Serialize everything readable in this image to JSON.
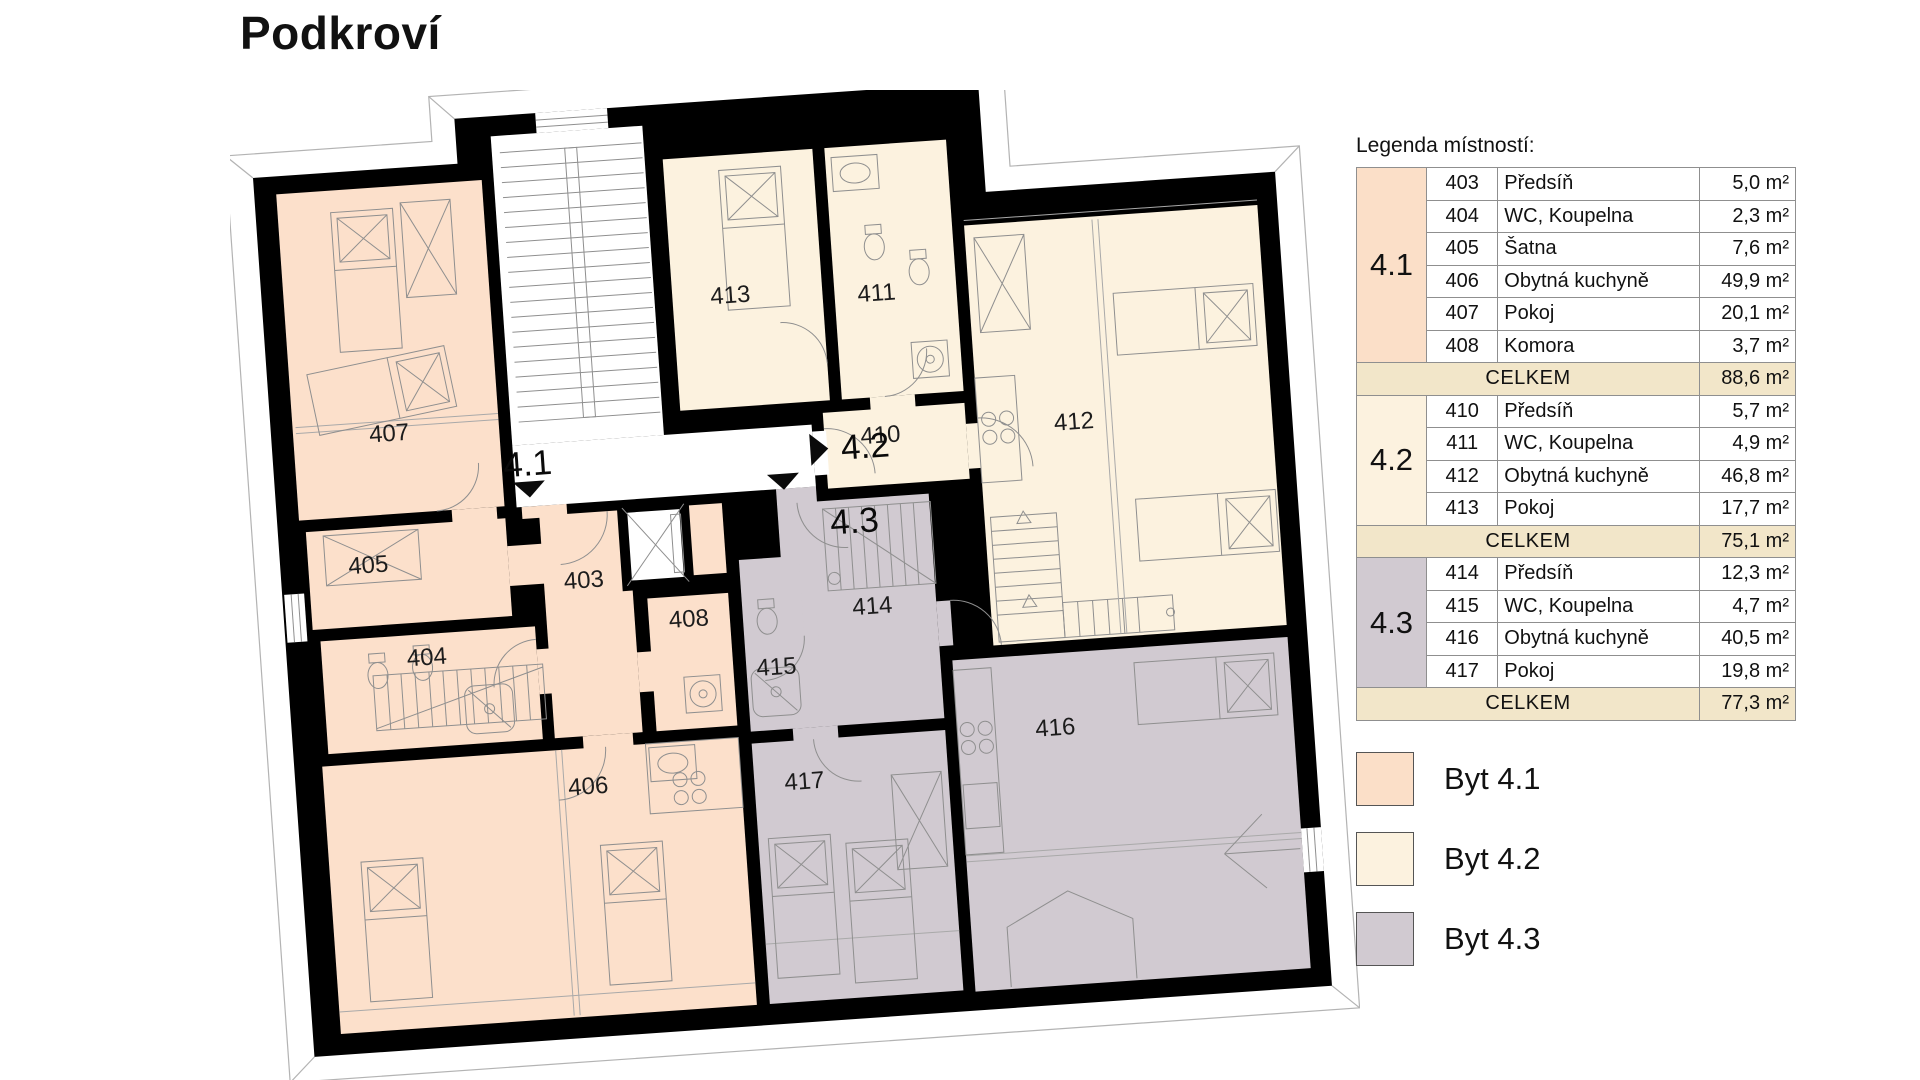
{
  "header": {
    "title": "Podkroví"
  },
  "plan": {
    "apartments": [
      {
        "id": "4.1",
        "label": "4.1",
        "color": "#fbdfc8",
        "entry_arrow": "down"
      },
      {
        "id": "4.2",
        "label": "4.2",
        "color": "#fcf2df",
        "entry_arrow": "right"
      },
      {
        "id": "4.3",
        "label": "4.3",
        "color": "#d1cad1",
        "entry_arrow": "down"
      }
    ],
    "rooms": {
      "403": {
        "label": "403"
      },
      "404": {
        "label": "404"
      },
      "405": {
        "label": "405"
      },
      "406": {
        "label": "406"
      },
      "407": {
        "label": "407"
      },
      "408": {
        "label": "408"
      },
      "410": {
        "label": "410"
      },
      "411": {
        "label": "411"
      },
      "412": {
        "label": "412"
      },
      "413": {
        "label": "413"
      },
      "414": {
        "label": "414"
      },
      "415": {
        "label": "415"
      },
      "416": {
        "label": "416"
      },
      "417": {
        "label": "417"
      }
    }
  },
  "legend": {
    "title": "Legenda místností:",
    "total_label": "CELKEM",
    "sections": [
      {
        "apartment": "4.1",
        "color": "#fbdfc8",
        "rows": [
          {
            "number": "403",
            "name": "Předsíň",
            "area": "5,0 m²"
          },
          {
            "number": "404",
            "name": "WC, Koupelna",
            "area": "2,3 m²"
          },
          {
            "number": "405",
            "name": "Šatna",
            "area": "7,6 m²"
          },
          {
            "number": "406",
            "name": "Obytná kuchyně",
            "area": "49,9 m²"
          },
          {
            "number": "407",
            "name": "Pokoj",
            "area": "20,1 m²"
          },
          {
            "number": "408",
            "name": "Komora",
            "area": "3,7 m²"
          }
        ],
        "total_area": "88,6 m²"
      },
      {
        "apartment": "4.2",
        "color": "#fcf2df",
        "rows": [
          {
            "number": "410",
            "name": "Předsíň",
            "area": "5,7 m²"
          },
          {
            "number": "411",
            "name": "WC, Koupelna",
            "area": "4,9 m²"
          },
          {
            "number": "412",
            "name": "Obytná kuchyně",
            "area": "46,8 m²"
          },
          {
            "number": "413",
            "name": "Pokoj",
            "area": "17,7 m²"
          }
        ],
        "total_area": "75,1 m²"
      },
      {
        "apartment": "4.3",
        "color": "#d1cad1",
        "rows": [
          {
            "number": "414",
            "name": "Předsíň",
            "area": "12,3 m²"
          },
          {
            "number": "415",
            "name": "WC, Koupelna",
            "area": "4,7 m²"
          },
          {
            "number": "416",
            "name": "Obytná kuchyně",
            "area": "40,5 m²"
          },
          {
            "number": "417",
            "name": "Pokoj",
            "area": "19,8 m²"
          }
        ],
        "total_area": "77,3 m²"
      }
    ]
  },
  "key": {
    "items": [
      {
        "label": "Byt 4.1",
        "color": "#fbdfc8"
      },
      {
        "label": "Byt 4.2",
        "color": "#fcf2df"
      },
      {
        "label": "Byt 4.3",
        "color": "#d1cad1"
      }
    ]
  },
  "colors": {
    "wall": "#000000",
    "celkem_bg": "#f2e6c9",
    "drawing_line": "#8f8f8f"
  }
}
